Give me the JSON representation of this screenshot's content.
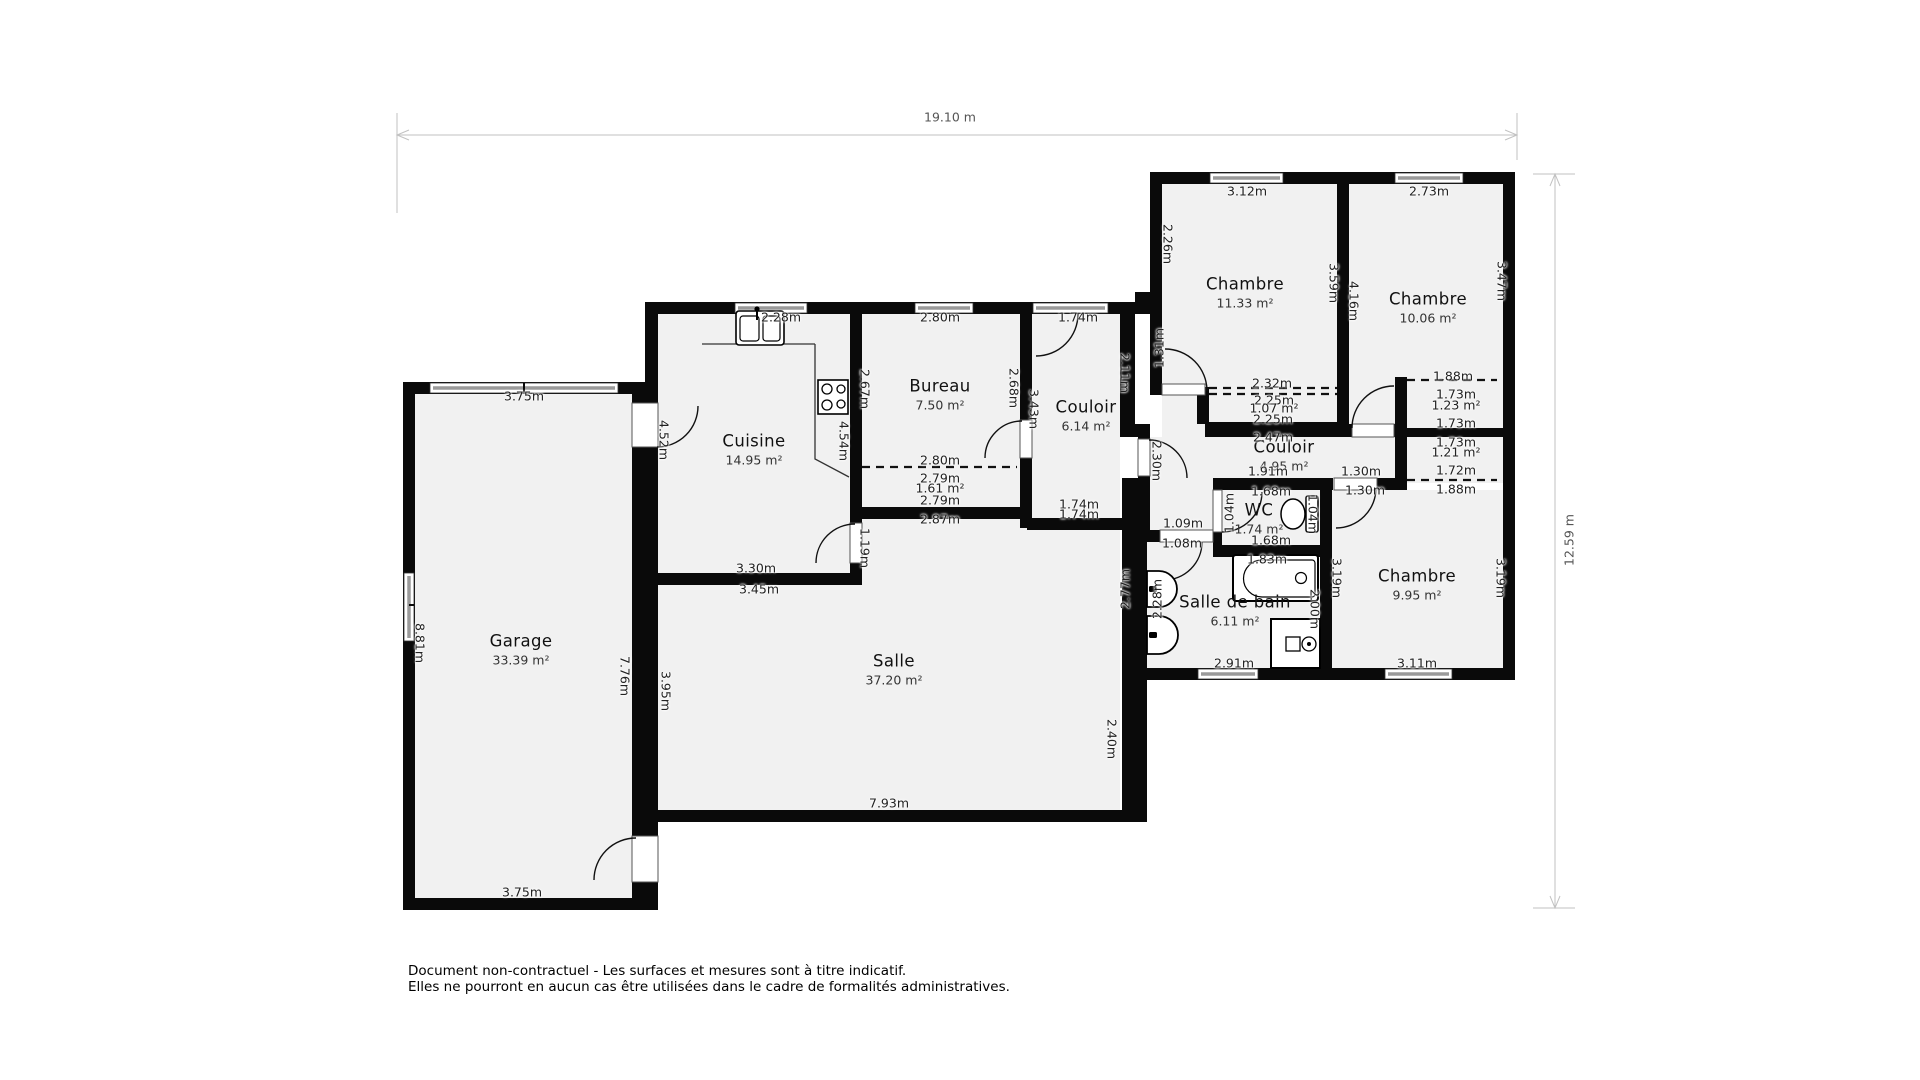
{
  "dimensions": {
    "total_width": "19.10 m",
    "total_height": "12.59 m"
  },
  "rooms": [
    {
      "name": "Chambre",
      "area": "11.33 m²",
      "x": 1245,
      "y": 286
    },
    {
      "name": "Chambre",
      "area": "10.06 m²",
      "x": 1428,
      "y": 301
    },
    {
      "name": "Cuisine",
      "area": "14.95 m²",
      "x": 754,
      "y": 443
    },
    {
      "name": "Bureau",
      "area": "7.50 m²",
      "x": 940,
      "y": 388
    },
    {
      "name": "Couloir",
      "area": "6.14 m²",
      "x": 1086,
      "y": 409
    },
    {
      "name": "Couloir",
      "area": "4.95 m²",
      "x": 1284,
      "y": 449
    },
    {
      "name": "WC",
      "area": "1.74 m²",
      "x": 1259,
      "y": 512
    },
    {
      "name": "Salle de bain",
      "area": "6.11 m²",
      "x": 1235,
      "y": 604
    },
    {
      "name": "Chambre",
      "area": "9.95 m²",
      "x": 1417,
      "y": 578
    },
    {
      "name": "Salle",
      "area": "37.20 m²",
      "x": 894,
      "y": 663
    },
    {
      "name": "Garage",
      "area": "33.39 m²",
      "x": 521,
      "y": 643
    }
  ],
  "measurements": [
    {
      "t": "3.75m",
      "x": 524,
      "y": 396,
      "r": "h"
    },
    {
      "t": "8.81m",
      "x": 420,
      "y": 643,
      "r": "cw"
    },
    {
      "t": "3.75m",
      "x": 522,
      "y": 892,
      "r": "h"
    },
    {
      "t": "7.76m",
      "x": 625,
      "y": 676,
      "r": "cw"
    },
    {
      "t": "3.95m",
      "x": 666,
      "y": 691,
      "r": "cw"
    },
    {
      "t": "4.52m",
      "x": 664,
      "y": 440,
      "r": "cw"
    },
    {
      "t": "2.28m",
      "x": 781,
      "y": 317,
      "r": "h"
    },
    {
      "t": "2.80m",
      "x": 940,
      "y": 317,
      "r": "h"
    },
    {
      "t": "1.74m",
      "x": 1078,
      "y": 317,
      "r": "h"
    },
    {
      "t": "2.67m",
      "x": 865,
      "y": 389,
      "r": "cw"
    },
    {
      "t": "4.54m",
      "x": 844,
      "y": 441,
      "r": "cw"
    },
    {
      "t": "2.68m",
      "x": 1014,
      "y": 388,
      "r": "cw"
    },
    {
      "t": "3.43m",
      "x": 1034,
      "y": 409,
      "r": "cw"
    },
    {
      "t": "2.11m",
      "x": 1125,
      "y": 373,
      "r": "cw"
    },
    {
      "t": "2.26m",
      "x": 1168,
      "y": 244,
      "r": "cw"
    },
    {
      "t": "3.12m",
      "x": 1247,
      "y": 191,
      "r": "h"
    },
    {
      "t": "2.73m",
      "x": 1429,
      "y": 191,
      "r": "h"
    },
    {
      "t": "3.59m",
      "x": 1334,
      "y": 283,
      "r": "cw"
    },
    {
      "t": "4.16m",
      "x": 1354,
      "y": 301,
      "r": "cw"
    },
    {
      "t": "3.47m",
      "x": 1502,
      "y": 281,
      "r": "cw"
    },
    {
      "t": "2.32m",
      "x": 1272,
      "y": 383,
      "r": "h"
    },
    {
      "t": "2.25m",
      "x": 1274,
      "y": 400,
      "r": "h"
    },
    {
      "t": "1.07 m²",
      "x": 1274,
      "y": 408,
      "r": "h"
    },
    {
      "t": "2.25m",
      "x": 1273,
      "y": 419,
      "r": "h"
    },
    {
      "t": "1.31m",
      "x": 1159,
      "y": 348,
      "r": "ccw"
    },
    {
      "t": "2.47m",
      "x": 1273,
      "y": 437,
      "r": "h"
    },
    {
      "t": "1.91m",
      "x": 1268,
      "y": 471,
      "r": "h"
    },
    {
      "t": "1.30m",
      "x": 1361,
      "y": 471,
      "r": "h"
    },
    {
      "t": "1.30m",
      "x": 1365,
      "y": 490,
      "r": "h"
    },
    {
      "t": "1.88m",
      "x": 1453,
      "y": 376,
      "r": "h"
    },
    {
      "t": "1.73m",
      "x": 1456,
      "y": 394,
      "r": "h"
    },
    {
      "t": "1.23 m²",
      "x": 1456,
      "y": 405,
      "r": "h"
    },
    {
      "t": "1.73m",
      "x": 1456,
      "y": 423,
      "r": "h"
    },
    {
      "t": "1.73m",
      "x": 1456,
      "y": 442,
      "r": "h"
    },
    {
      "t": "1.21 m²",
      "x": 1456,
      "y": 452,
      "r": "h"
    },
    {
      "t": "1.72m",
      "x": 1456,
      "y": 470,
      "r": "h"
    },
    {
      "t": "1.88m",
      "x": 1456,
      "y": 489,
      "r": "h"
    },
    {
      "t": "2.80m",
      "x": 940,
      "y": 460,
      "r": "h"
    },
    {
      "t": "2.79m",
      "x": 940,
      "y": 478,
      "r": "h"
    },
    {
      "t": "1.61 m²",
      "x": 940,
      "y": 488,
      "r": "h"
    },
    {
      "t": "2.79m",
      "x": 940,
      "y": 500,
      "r": "h"
    },
    {
      "t": "2.87m",
      "x": 940,
      "y": 519,
      "r": "h"
    },
    {
      "t": "3.30m",
      "x": 756,
      "y": 568,
      "r": "h"
    },
    {
      "t": "3.45m",
      "x": 759,
      "y": 589,
      "r": "h"
    },
    {
      "t": "1.19m",
      "x": 865,
      "y": 548,
      "r": "cw"
    },
    {
      "t": "1.74m",
      "x": 1079,
      "y": 504,
      "r": "h"
    },
    {
      "t": "1.74m",
      "x": 1079,
      "y": 514,
      "r": "h"
    },
    {
      "t": "1.09m",
      "x": 1183,
      "y": 523,
      "r": "h"
    },
    {
      "t": "1.08m",
      "x": 1182,
      "y": 543,
      "r": "h"
    },
    {
      "t": "1.68m",
      "x": 1271,
      "y": 491,
      "r": "h"
    },
    {
      "t": "1.04m",
      "x": 1229,
      "y": 513,
      "r": "ccw"
    },
    {
      "t": "1.04m",
      "x": 1313,
      "y": 514,
      "r": "cw"
    },
    {
      "t": "1.68m",
      "x": 1271,
      "y": 540,
      "r": "h"
    },
    {
      "t": "1.83m",
      "x": 1267,
      "y": 559,
      "r": "h"
    },
    {
      "t": "2.28m",
      "x": 1157,
      "y": 599,
      "r": "ccw"
    },
    {
      "t": "2.00m",
      "x": 1315,
      "y": 609,
      "r": "cw"
    },
    {
      "t": "2.77m",
      "x": 1125,
      "y": 589,
      "r": "ccw"
    },
    {
      "t": "2.40m",
      "x": 1112,
      "y": 739,
      "r": "cw"
    },
    {
      "t": "2.91m",
      "x": 1234,
      "y": 663,
      "r": "h"
    },
    {
      "t": "3.11m",
      "x": 1417,
      "y": 663,
      "r": "h"
    },
    {
      "t": "3.19m",
      "x": 1337,
      "y": 578,
      "r": "cw"
    },
    {
      "t": "3.19m",
      "x": 1501,
      "y": 578,
      "r": "cw"
    },
    {
      "t": "7.93m",
      "x": 889,
      "y": 803,
      "r": "h"
    },
    {
      "t": "2.30m",
      "x": 1157,
      "y": 461,
      "r": "cw"
    }
  ],
  "disclaimer": [
    "Document non-contractuel - Les surfaces et mesures sont à titre indicatif.",
    "Elles ne pourront en aucun cas être utilisées dans le cadre de formalités administratives."
  ],
  "colors": {
    "wall": "#0a0a0a",
    "room_fill": "#f1f1f1",
    "dim_line": "#c2c2c2",
    "dim_text": "#222222"
  }
}
